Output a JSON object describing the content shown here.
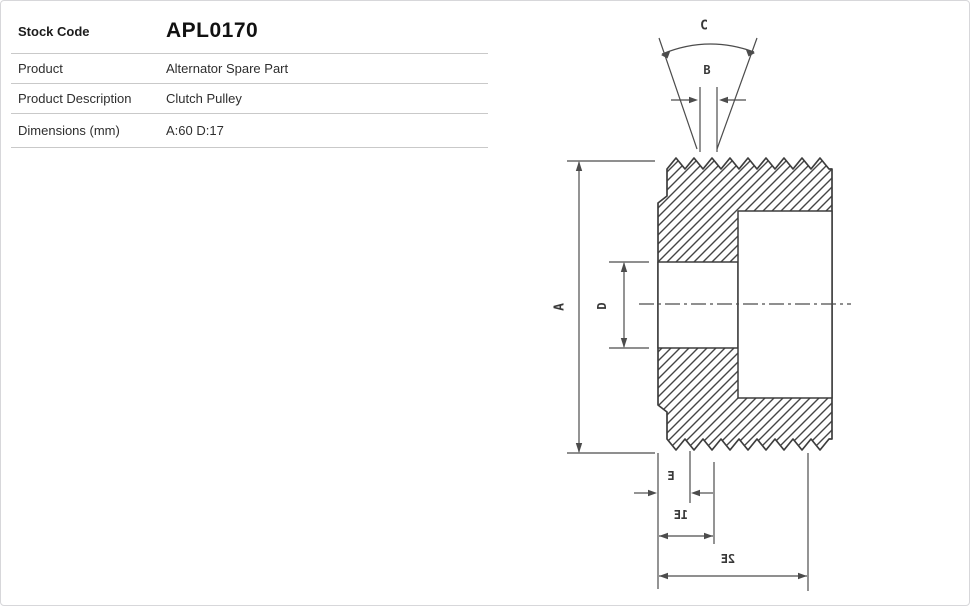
{
  "page": {
    "background": "#ffffff",
    "border_color": "#d7d7da"
  },
  "product_table": {
    "rows": [
      {
        "label": "Stock Code",
        "value": "APL0170"
      },
      {
        "label": "Product",
        "value": "Alternator Spare Part"
      },
      {
        "label": "Product Description",
        "value": "Clutch Pulley"
      },
      {
        "label": "Dimensions (mm)",
        "value": "A:60 D:17"
      }
    ]
  },
  "diagram": {
    "type": "technical-drawing",
    "subject": "Clutch pulley cross-section with poly-V belt grooves and V-groove detail",
    "line_color": "#3d3d3d",
    "labels": {
      "A": "A",
      "B": "B",
      "C": "C",
      "D": "D",
      "E": "E",
      "E1": "E1",
      "E2": "E2"
    }
  }
}
